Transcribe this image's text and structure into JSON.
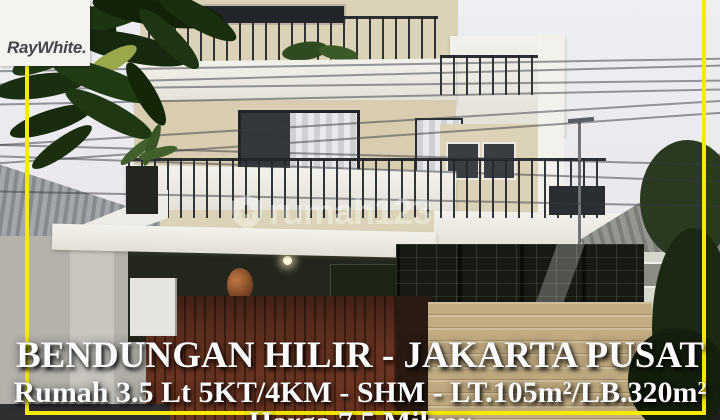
{
  "branding": {
    "agency_logo_text": "RayWhite."
  },
  "watermark": {
    "brand_text": "rumah123"
  },
  "caption": {
    "location_line": "BENDUNGAN HILIR - JAKARTA PUSAT",
    "details_line": "Rumah 3.5 Lt 5KT/4KM - SHM - LT.105m²/LB.320m²",
    "price_line": "Harga 7.5 Milyar"
  },
  "colors": {
    "frame_yellow": "#f6eb00",
    "caption_text": "#fafafa",
    "logo_text": "#47474b",
    "logo_background": "#f4f3f0"
  },
  "photo": {
    "subject": "Modern 3.5-storey house exterior listing photo, Bendungan Hilir, Jakarta Pusat"
  }
}
